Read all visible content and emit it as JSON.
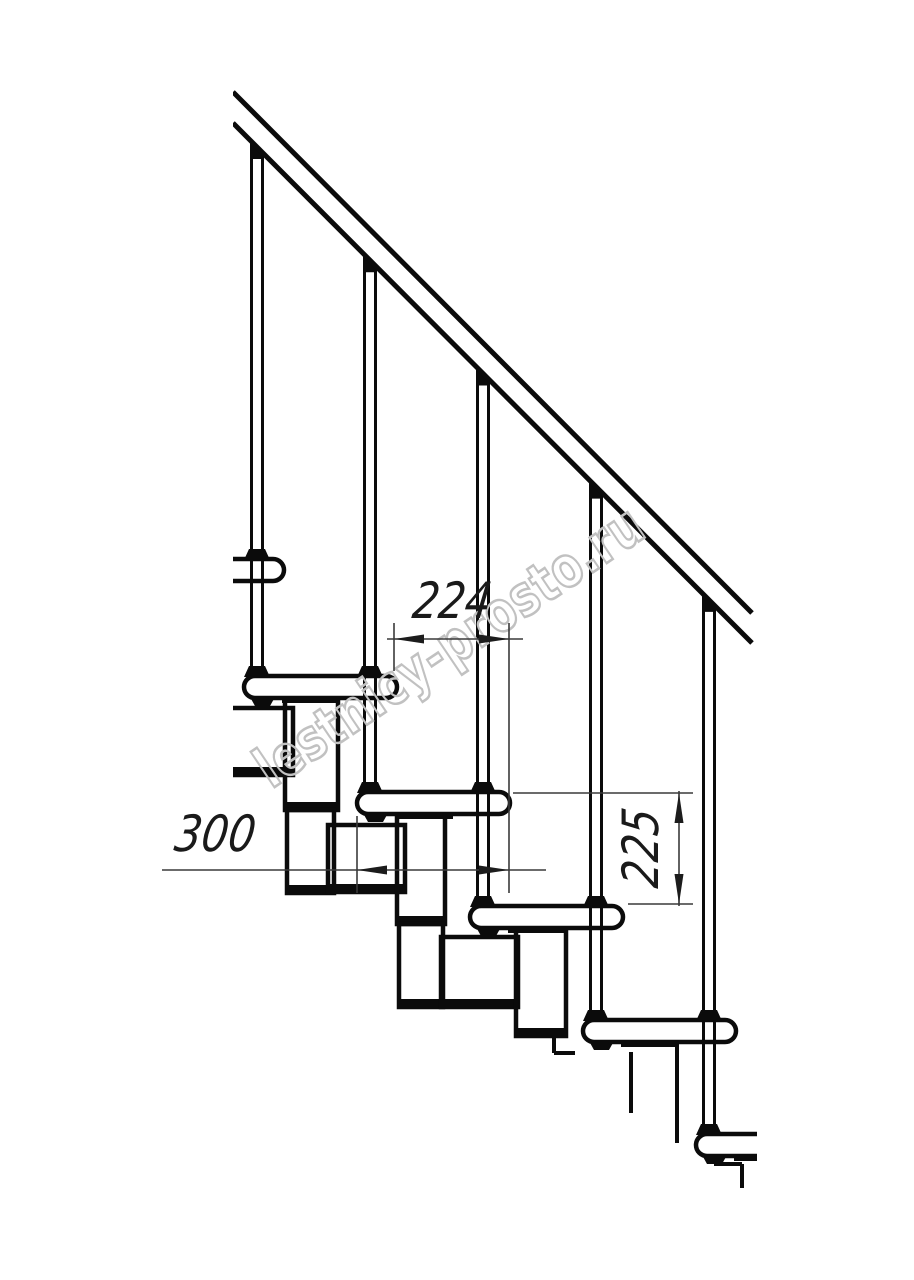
{
  "title": "Staircase side-view technical drawing",
  "canvas": {
    "width": 914,
    "height": 1280,
    "background": "#ffffff"
  },
  "colors": {
    "line": "#0b0b0b",
    "thin": "#3a3a3a",
    "arrow": "#1c1c1c",
    "text": "#1a1a1a",
    "fill": "#ffffff",
    "watermark": "#c1c1c1"
  },
  "watermark": {
    "text": "lestnicy-prosto.ru",
    "angle": -34,
    "cx": 460,
    "cy": 662,
    "font_size": 56,
    "text_length": 455,
    "stroke_width": 2.6
  },
  "structure": {
    "clip_left": 233,
    "rail": {
      "upper": [
        233,
        92,
        752,
        613
      ],
      "lower": [
        233,
        123,
        752,
        643
      ],
      "stroke": 5
    },
    "tread_size": {
      "w": 153,
      "h": 22,
      "r": 11
    },
    "treads": [
      {
        "x": 131,
        "y": 559
      },
      {
        "x": 244,
        "y": 676
      },
      {
        "x": 357,
        "y": 792
      },
      {
        "x": 470,
        "y": 906
      },
      {
        "x": 583,
        "y": 1020
      },
      {
        "x": 696,
        "y": 1134,
        "clip_right": 757
      }
    ],
    "under_tread": {
      "nub_dx": 6,
      "nub_w": 25,
      "nub_h": 9,
      "strip_dx": 38,
      "strip_w": 58,
      "strip_h": 6
    },
    "balusters": [
      {
        "x": 257,
        "collar_y": 559,
        "foot_y": 676
      },
      {
        "x": 370,
        "collar_y": 676,
        "foot_y": 792
      },
      {
        "x": 483,
        "collar_y": 792,
        "foot_y": 906
      },
      {
        "x": 596,
        "collar_y": 906,
        "foot_y": 1020
      },
      {
        "x": 709,
        "collar_y": 1020,
        "foot_y": 1134
      }
    ],
    "baluster_style": {
      "half_gap": 5.5,
      "stroke": 3,
      "cap_half_w": 7,
      "foot_bottom_hw": 13,
      "foot_top_hw": 8,
      "foot_h": 10
    },
    "module_boxes": [
      {
        "x": 216,
        "y": 708,
        "w": 77,
        "h": 67
      },
      {
        "x": 285,
        "y": 698,
        "w": 53,
        "h": 112
      },
      {
        "x": 287,
        "y": 810,
        "w": 47,
        "h": 83
      },
      {
        "x": 328,
        "y": 825,
        "w": 77,
        "h": 67
      },
      {
        "x": 397,
        "y": 812,
        "w": 48,
        "h": 112
      },
      {
        "x": 399,
        "y": 924,
        "w": 44,
        "h": 83
      },
      {
        "x": 441,
        "y": 937,
        "w": 77,
        "h": 70
      },
      {
        "x": 516,
        "y": 925,
        "w": 50,
        "h": 111
      }
    ],
    "loose_lines": [
      [
        554,
        1036,
        554,
        1053
      ],
      [
        554,
        1053,
        575,
        1053
      ],
      [
        631,
        1052,
        631,
        1113
      ],
      [
        677,
        1042,
        677,
        1143
      ],
      [
        714,
        1164,
        742,
        1164
      ],
      [
        742,
        1164,
        742,
        1188
      ]
    ]
  },
  "dimensions": [
    {
      "id": "dim-224",
      "label": "224",
      "ext_lines": [
        [
          394,
          623,
          394,
          671
        ],
        [
          509,
          623,
          509,
          893
        ]
      ],
      "dim_line": [
        387,
        639,
        523,
        639
      ],
      "arrows": [
        {
          "tip": [
            394,
            639
          ],
          "dir": "left"
        },
        {
          "tip": [
            509,
            639
          ],
          "dir": "right"
        }
      ],
      "text": {
        "x": 450,
        "y": 618,
        "rotate": 0,
        "text_length": 78
      }
    },
    {
      "id": "dim-300",
      "label": "300",
      "ext_lines": [
        [
          357,
          816,
          357,
          893
        ]
      ],
      "dim_line": [
        162,
        870,
        546,
        870
      ],
      "arrows": [
        {
          "tip": [
            357,
            870
          ],
          "dir": "left"
        },
        {
          "tip": [
            509,
            870
          ],
          "dir": "right"
        }
      ],
      "text": {
        "x": 213,
        "y": 851,
        "rotate": 0,
        "text_length": 80
      }
    },
    {
      "id": "dim-225",
      "label": "225",
      "ext_lines": [
        [
          513,
          793,
          693,
          793
        ],
        [
          628,
          904,
          693,
          904
        ]
      ],
      "dim_line": [
        679,
        791,
        679,
        906
      ],
      "arrows": [
        {
          "tip": [
            679,
            793
          ],
          "dir": "up"
        },
        {
          "tip": [
            679,
            904
          ],
          "dir": "down"
        }
      ],
      "text": {
        "x": 658,
        "y": 850,
        "rotate": -90,
        "text_length": 78
      }
    }
  ],
  "dim_text_style": {
    "font_size": 50,
    "skew": -8
  }
}
